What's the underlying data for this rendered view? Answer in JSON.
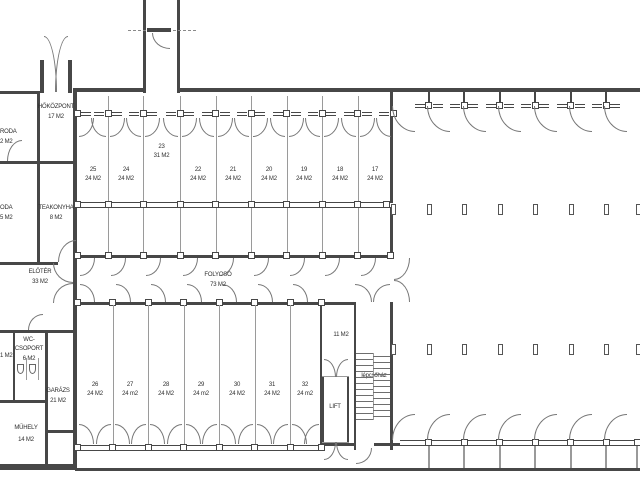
{
  "plan": {
    "left_wing": {
      "hokozpont": {
        "name": "HŐKÖZPONT",
        "area": "17 M2"
      },
      "iroda_upper_fragment": {
        "name": "RODA",
        "area": "2 M2"
      },
      "iroda_lower_fragment": {
        "name": "ODA",
        "area": "5 M2"
      },
      "teakonyha": {
        "name": "TEAKONYHA",
        "area": "8 M2"
      },
      "eloter": {
        "name": "ELŐTÉR",
        "area": "33 M2"
      },
      "wc_csoport": {
        "line1": "WC-",
        "line2": "CSOPORT",
        "area": "6 M2"
      },
      "edge_room_fragment": {
        "area": "1 M2"
      },
      "garazs": {
        "name": "GARÁZS",
        "area": "21 M2"
      },
      "muhely": {
        "name": "MŰHELY",
        "area": "14 M2"
      }
    },
    "corridor": {
      "name": "FOLYOSÓ",
      "area": "73 M2"
    },
    "core": {
      "vestibule_area": "11 M2",
      "lift": "LIFT",
      "staircase": "lépcsőház"
    },
    "top_rooms": [
      {
        "number": "25",
        "area": "24 M2"
      },
      {
        "number": "24",
        "area": "24 M2"
      },
      {
        "number": "23",
        "area": "31 M2"
      },
      {
        "number": "22",
        "area": "24 M2"
      },
      {
        "number": "21",
        "area": "24 M2"
      },
      {
        "number": "20",
        "area": "24 M2"
      },
      {
        "number": "19",
        "area": "24 M2"
      },
      {
        "number": "18",
        "area": "24 M2"
      },
      {
        "number": "17",
        "area": "24 M2"
      }
    ],
    "bottom_rooms": [
      {
        "number": "26",
        "area": "24 M2"
      },
      {
        "number": "27",
        "area": "24 m2"
      },
      {
        "number": "28",
        "area": "24 M2"
      },
      {
        "number": "29",
        "area": "24 m2"
      },
      {
        "number": "30",
        "area": "24 M2"
      },
      {
        "number": "31",
        "area": "24 M2"
      },
      {
        "number": "32",
        "area": "24 m2"
      }
    ]
  }
}
